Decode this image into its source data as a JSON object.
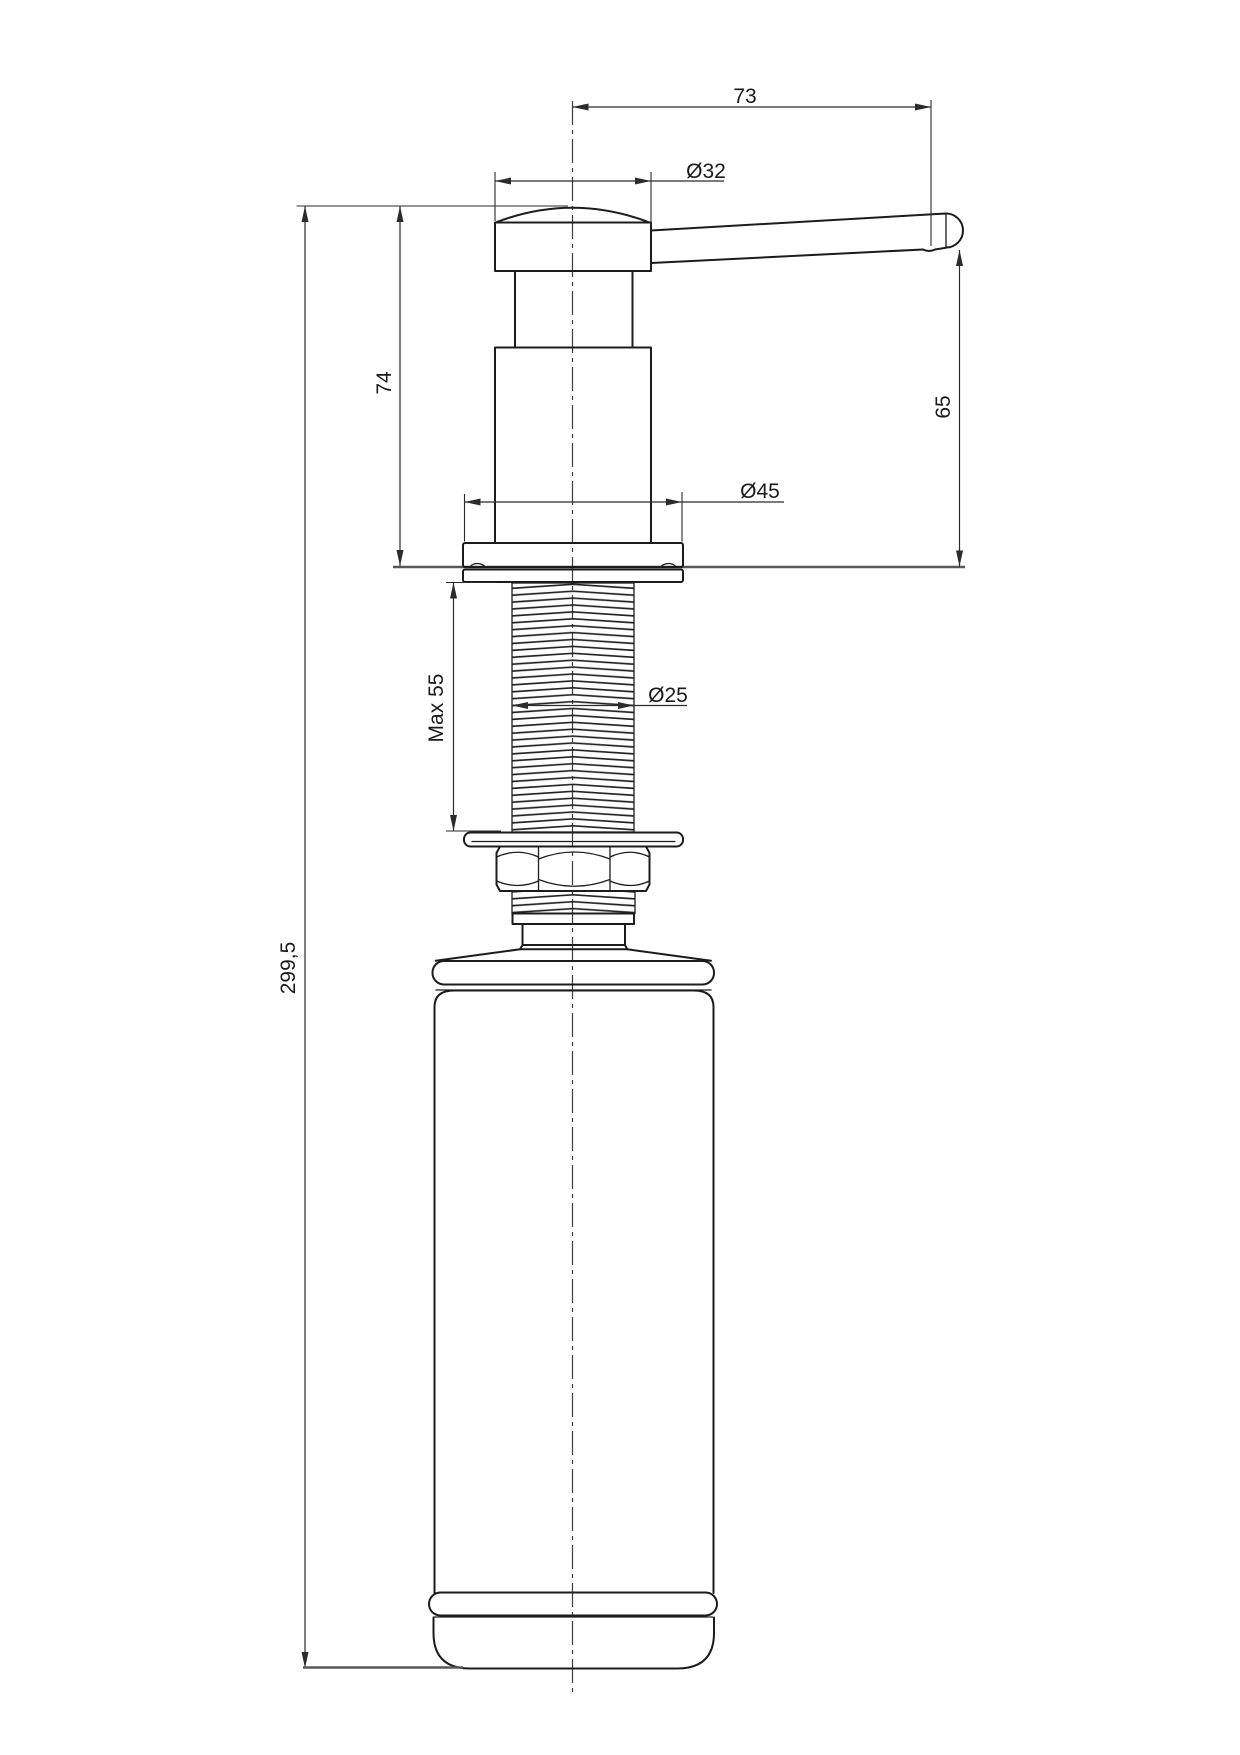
{
  "drawing": {
    "type": "technical-dimension-drawing",
    "subject": "kitchen sink soap dispenser, side elevation",
    "dimensions": {
      "spout_reach": "73",
      "cap_diameter": "Ø32",
      "height_above_counter": "74",
      "spout_clearance": "65",
      "flange_diameter": "Ø45",
      "max_counter_thickness": "Max 55",
      "thread_diameter": "Ø25",
      "overall_height": "299,5"
    },
    "colors": {
      "outline": "#1c1c1c",
      "dimension_lines": "#2b2b2b",
      "counter_line": "#585858",
      "centerline": "#3a3a3a",
      "background": "#ffffff"
    }
  }
}
